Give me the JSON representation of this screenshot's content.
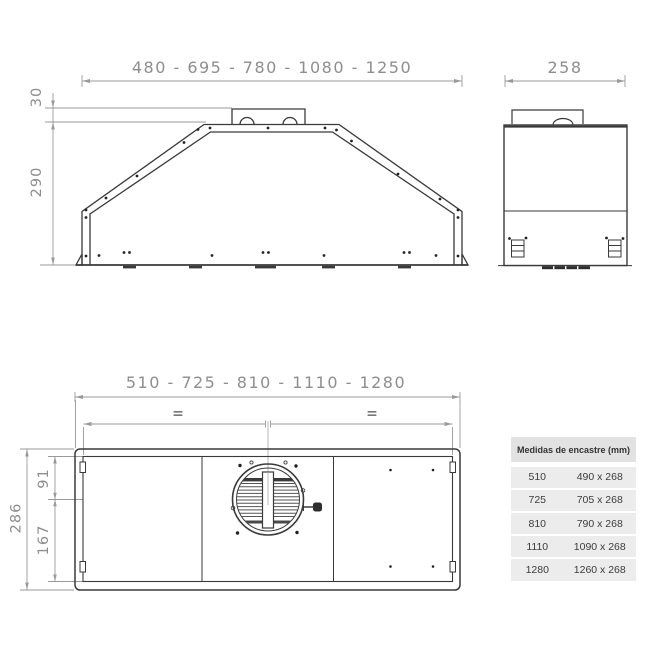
{
  "colors": {
    "drawing_line": "#3a3a3a",
    "dimension_line": "#9a9a9a",
    "dimension_text": "#8e8e8e",
    "table_header_bg": "#e2e2e2",
    "table_row_bg": "#ececec",
    "table_text": "#3c3c3c"
  },
  "front_view": {
    "width_label": "480 - 695 - 780 - 1080 - 1250",
    "duct_height_label": "30",
    "body_height_label": "290"
  },
  "side_view": {
    "depth_label": "258"
  },
  "bottom_view": {
    "width_label": "510 - 725 - 810 - 1110 - 1280",
    "total_depth_label": "286",
    "front_depth_label": "91",
    "rear_depth_label": "167",
    "equal_mark_left": "=",
    "equal_mark_right": "="
  },
  "table": {
    "header": "Medidas de encastre (mm)",
    "rows": [
      {
        "model": "510",
        "size": "490 x 268"
      },
      {
        "model": "725",
        "size": "705 x 268"
      },
      {
        "model": "810",
        "size": "790 x 268"
      },
      {
        "model": "1110",
        "size": "1090 x 268"
      },
      {
        "model": "1280",
        "size": "1260 x 268"
      }
    ]
  }
}
